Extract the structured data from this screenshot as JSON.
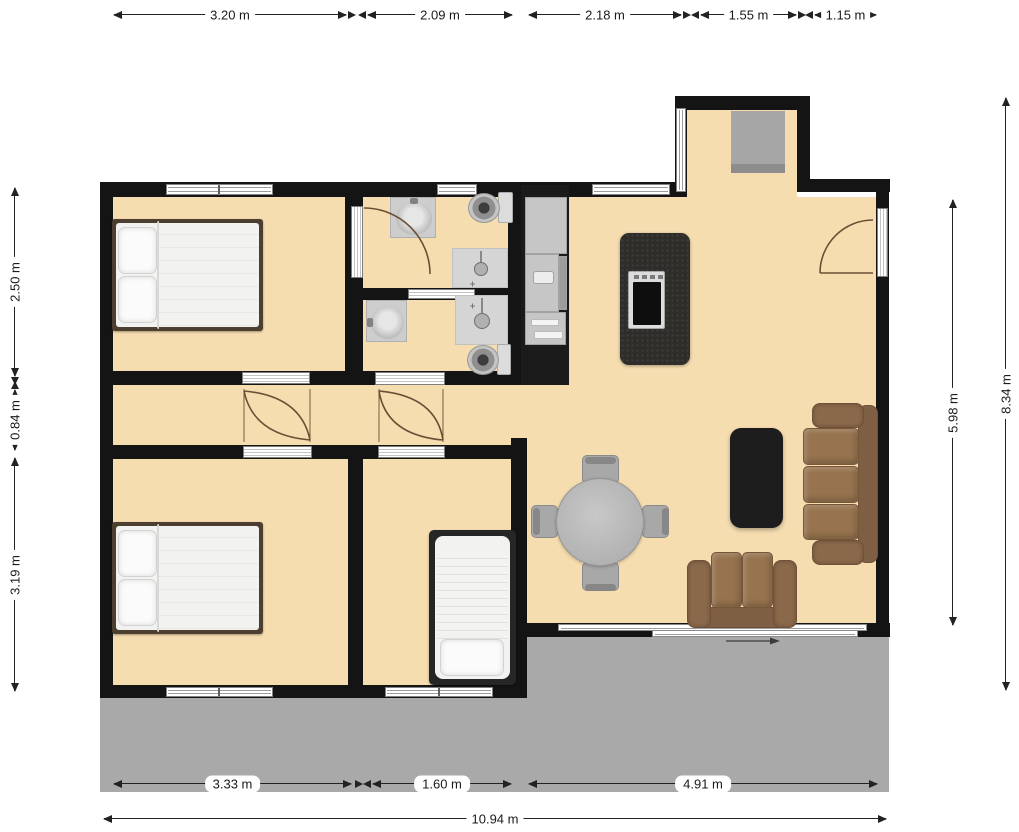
{
  "dimensions": {
    "top": [
      {
        "label": "3.20 m"
      },
      {
        "label": "2.09 m"
      },
      {
        "label": "2.18 m"
      },
      {
        "label": "1.55 m"
      },
      {
        "label": "1.15 m"
      }
    ],
    "left": [
      {
        "label": "2.50 m"
      },
      {
        "label": "0.84 m"
      },
      {
        "label": "3.19 m"
      }
    ],
    "right": [
      {
        "label": "5.98 m"
      },
      {
        "label": "8.34 m"
      }
    ],
    "bottom": [
      {
        "label": "3.33 m"
      },
      {
        "label": "1.60 m"
      },
      {
        "label": "4.91 m"
      }
    ],
    "total": {
      "label": "10.94 m"
    }
  },
  "colors": {
    "floor": "#f6ddb0",
    "wall": "#141414",
    "terrace": "#a9a9a9",
    "sofa": "#97744f",
    "island": "#2e2d29",
    "rug": "#1d1d1d",
    "table": "#b5b5b5",
    "bed_frame": "#4c3f30",
    "dimension_text": "#1a1a1a"
  }
}
